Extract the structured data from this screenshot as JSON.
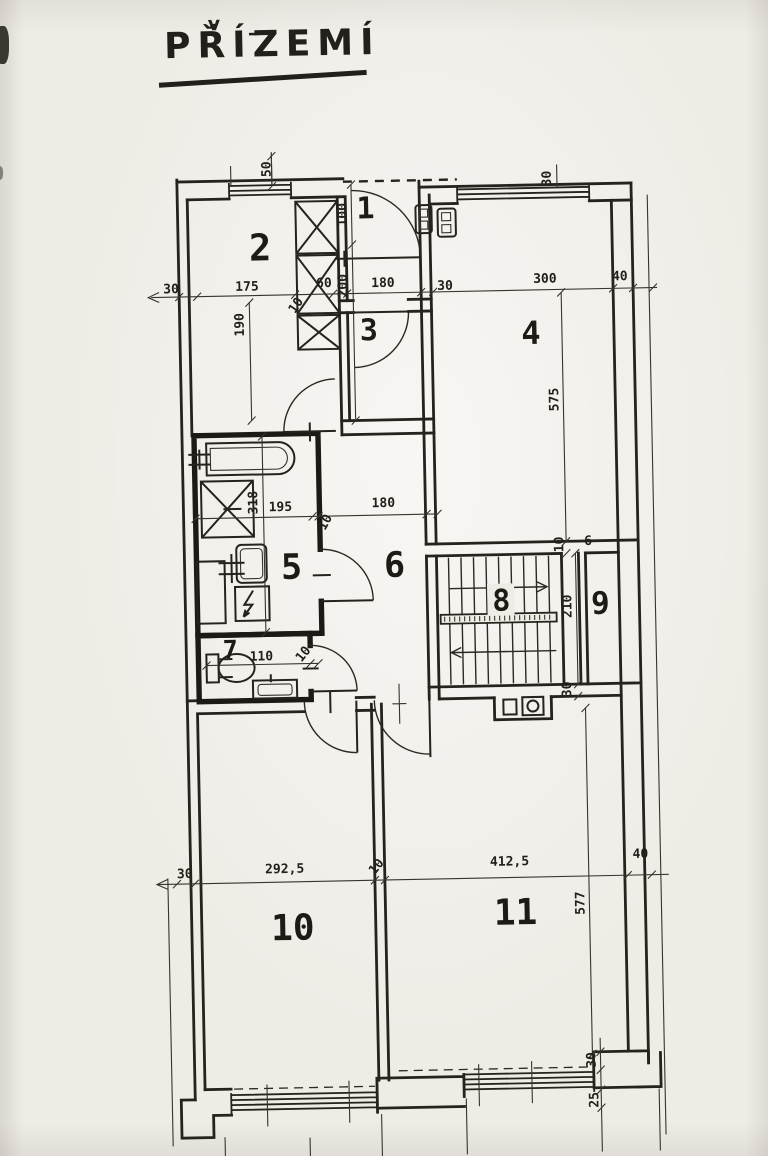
{
  "title": {
    "text": "PŘÍZEMÍ",
    "caron_mark": "v",
    "macron_mark": "–"
  },
  "rooms": [
    {
      "label": "1"
    },
    {
      "label": "2"
    },
    {
      "label": "3"
    },
    {
      "label": "4"
    },
    {
      "label": "5"
    },
    {
      "label": "6"
    },
    {
      "label": "7"
    },
    {
      "label": "8"
    },
    {
      "label": "9"
    },
    {
      "label": "10"
    },
    {
      "label": "11"
    }
  ],
  "dims": [
    {
      "text": "50"
    },
    {
      "text": "30"
    },
    {
      "text": "175"
    },
    {
      "text": "190"
    },
    {
      "text": "60"
    },
    {
      "text": "10"
    },
    {
      "text": "180"
    },
    {
      "text": "30"
    },
    {
      "text": "300"
    },
    {
      "text": "40"
    },
    {
      "text": "100"
    },
    {
      "text": "200"
    },
    {
      "text": "318"
    },
    {
      "text": "195"
    },
    {
      "text": "10"
    },
    {
      "text": "180"
    },
    {
      "text": "575"
    },
    {
      "text": "10"
    },
    {
      "text": "6"
    },
    {
      "text": "210"
    },
    {
      "text": "30"
    },
    {
      "text": "110"
    },
    {
      "text": "10"
    },
    {
      "text": "30"
    },
    {
      "text": "292,5"
    },
    {
      "text": "10"
    },
    {
      "text": "412,5"
    },
    {
      "text": "40"
    },
    {
      "text": "577"
    },
    {
      "text": "30"
    },
    {
      "text": "25"
    },
    {
      "text": "30"
    }
  ],
  "colors": {
    "paper": "#efece6",
    "ink": "#23201c"
  }
}
